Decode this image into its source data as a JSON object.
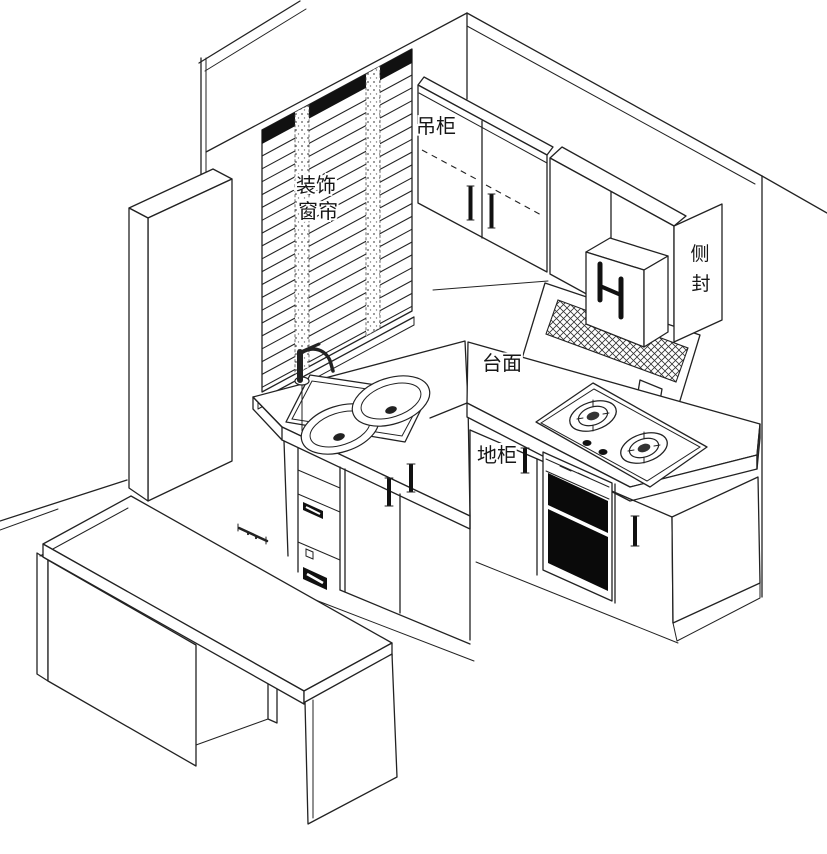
{
  "diagram": {
    "type": "kitchen-isometric-line-drawing",
    "labels": {
      "decor_curtain_line1": "装饰",
      "decor_curtain_line2": "窗帘",
      "wall_cabinet": "吊柜",
      "side_seal_char1": "侧",
      "side_seal_char2": "封",
      "countertop": "台面",
      "base_cabinet": "地柜"
    },
    "colors": {
      "line": "#222222",
      "background": "#ffffff",
      "solid_fill": "#111111",
      "hatch": "#333333"
    }
  }
}
